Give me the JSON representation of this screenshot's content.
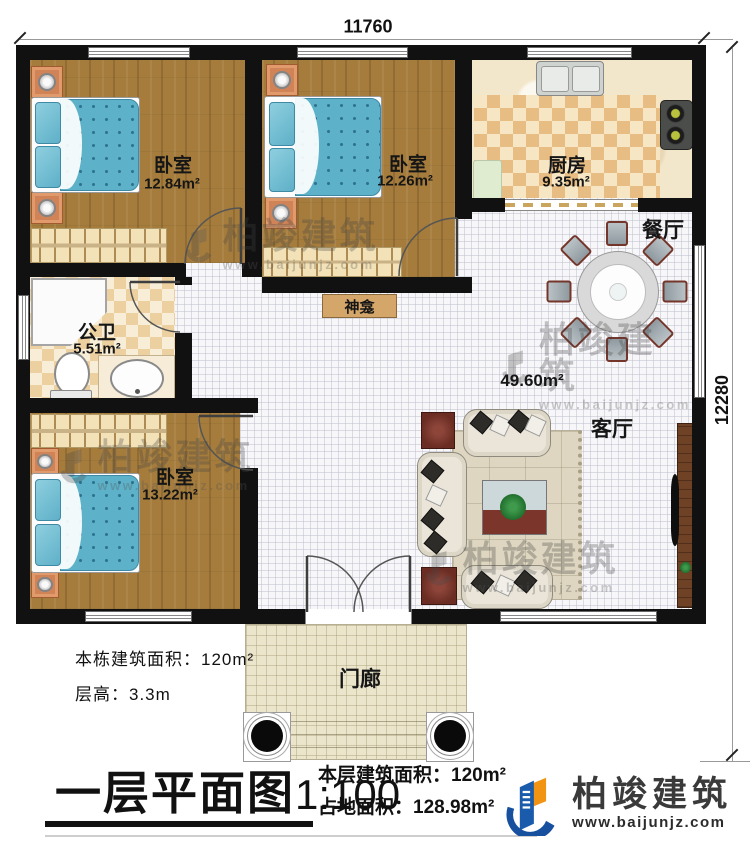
{
  "plan": {
    "dimensions": {
      "top": "11760",
      "right": "12280"
    },
    "rooms": [
      {
        "id": "bedroom1",
        "name": "卧室",
        "area": "12.84m²"
      },
      {
        "id": "bedroom2",
        "name": "卧室",
        "area": "12.26m²"
      },
      {
        "id": "kitchen",
        "name": "厨房",
        "area": "9.35m²"
      },
      {
        "id": "dining",
        "name": "餐厅"
      },
      {
        "id": "bathroom",
        "name": "公卫",
        "area": "5.51m²"
      },
      {
        "id": "shrine",
        "name": "神龛"
      },
      {
        "id": "living",
        "name": "客厅",
        "area": "49.60m²"
      },
      {
        "id": "bedroom3",
        "name": "卧室",
        "area": "13.22m²"
      },
      {
        "id": "porch",
        "name": "门廊"
      }
    ]
  },
  "annotations": {
    "building_area": "本栋建筑面积：120m²",
    "floor_height": "层高：3.3m"
  },
  "title_block": {
    "title": "一层平面图",
    "scale": "1:100",
    "floor_area": "本层建筑面积：120m²",
    "footprint_area": "占地面积：128.98m²"
  },
  "branding": {
    "company": "柏竣建筑",
    "website": "www.baijunjz.com"
  },
  "watermark": {
    "text": "柏竣建筑",
    "url": "www.baijunjz.com"
  },
  "colors": {
    "wall": "#111111",
    "wood_floor": "#a57c3c",
    "kitchen_checker": "#e7bd83",
    "hall_tile": "#f7f7f9",
    "bed_blue": "#5db2c9",
    "brand_blue": "#1a5cab",
    "brand_orange": "#f29413",
    "accent_red_wood": "#7a352a"
  }
}
